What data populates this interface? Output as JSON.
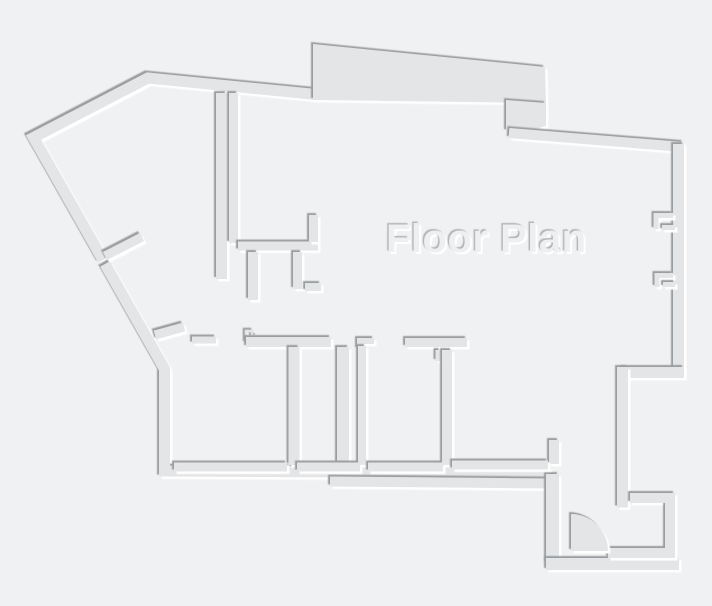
{
  "canvas": {
    "width": 712,
    "height": 606
  },
  "style": {
    "background": "#f0f1f2",
    "wall_fill": "#e4e5e6",
    "edge_dark": "#9b9ea0",
    "edge_light": "#ffffff"
  },
  "title": {
    "text": "Floor Plan",
    "color": "#edeff0",
    "shadow_dark": "#b2b5b7",
    "shadow_light": "#ffffff"
  },
  "pieces": [
    {
      "name": "outer-wall-upper-left",
      "type": "line",
      "w": 11,
      "pts": [
        [
          316,
          94.5
        ],
        [
          148,
          78
        ],
        [
          33.5,
          137.5
        ],
        [
          103,
          260
        ]
      ]
    },
    {
      "name": "outer-wall-lower-left",
      "type": "line",
      "w": 11,
      "pts": [
        [
          105,
          264
        ],
        [
          164.5,
          369
        ],
        [
          164.5,
          471
        ],
        [
          550,
          473
        ]
      ]
    },
    {
      "name": "bottom-outer-band",
      "type": "line",
      "w": 10,
      "pts": [
        [
          330,
          481.5
        ],
        [
          552,
          483.5
        ]
      ]
    },
    {
      "name": "entry-left-wall",
      "type": "line",
      "w": 13,
      "pts": [
        [
          552.5,
          474
        ],
        [
          552.5,
          563
        ]
      ]
    },
    {
      "name": "entry-bottom-outer-wall",
      "type": "line",
      "w": 12,
      "pts": [
        [
          546,
          564
        ],
        [
          679,
          564
        ]
      ]
    },
    {
      "name": "top-protrusion",
      "type": "poly",
      "pts": [
        [
          313,
          44
        ],
        [
          545,
          67
        ],
        [
          546,
          103
        ],
        [
          313,
          100
        ]
      ]
    },
    {
      "name": "protrusion-step",
      "type": "poly",
      "pts": [
        [
          506,
          100
        ],
        [
          546,
          103
        ],
        [
          546,
          126
        ],
        [
          518,
          134
        ],
        [
          506,
          131
        ]
      ]
    },
    {
      "name": "top-wall-right",
      "type": "line",
      "w": 10,
      "pts": [
        [
          509,
          133
        ],
        [
          683,
          147
        ]
      ]
    },
    {
      "name": "right-wall",
      "type": "line",
      "w": 11,
      "pts": [
        [
          678.5,
          144
        ],
        [
          678.5,
          373
        ]
      ]
    },
    {
      "name": "entry-jog-wall",
      "type": "line",
      "w": 11,
      "pts": [
        [
          684,
          372.5
        ],
        [
          622.5,
          372.5
        ]
      ]
    },
    {
      "name": "entry-upper-wall",
      "type": "line",
      "w": 11,
      "pts": [
        [
          622.5,
          367
        ],
        [
          622.5,
          507.5
        ]
      ]
    },
    {
      "name": "entry-inner-wall",
      "type": "line",
      "w": 10,
      "pts": [
        [
          630,
          498
        ],
        [
          670,
          498
        ],
        [
          670,
          553
        ],
        [
          608,
          553
        ]
      ]
    },
    {
      "name": "interior-wall-v1",
      "type": "line",
      "w": 11,
      "pts": [
        [
          221.5,
          93
        ],
        [
          221.5,
          279
        ]
      ]
    },
    {
      "name": "interior-wall-v2",
      "type": "line",
      "w": 9,
      "pts": [
        [
          233.5,
          93
        ],
        [
          233.5,
          243
        ]
      ]
    },
    {
      "name": "interior-wall-h1",
      "type": "line",
      "w": 9,
      "pts": [
        [
          238,
          246
        ],
        [
          318,
          246
        ]
      ]
    },
    {
      "name": "h1-riser",
      "type": "line",
      "w": 9,
      "pts": [
        [
          313.5,
          215
        ],
        [
          313.5,
          242
        ]
      ]
    },
    {
      "name": "closet-stub-a",
      "type": "line",
      "w": 10,
      "pts": [
        [
          253,
          252
        ],
        [
          253,
          300
        ]
      ]
    },
    {
      "name": "closet-stub-b",
      "type": "line",
      "w": 9,
      "pts": [
        [
          297.5,
          252
        ],
        [
          297.5,
          289
        ]
      ]
    },
    {
      "name": "closet-stub-c",
      "type": "line",
      "w": 8,
      "pts": [
        [
          305,
          287
        ],
        [
          321,
          287
        ]
      ]
    },
    {
      "name": "diag-door-jamb-a",
      "type": "line",
      "w": 9,
      "pts": [
        [
          105,
          256
        ],
        [
          142,
          237
        ]
      ]
    },
    {
      "name": "diag-door-jamb-b",
      "type": "line",
      "w": 9,
      "pts": [
        [
          155,
          335
        ],
        [
          184,
          327
        ]
      ]
    },
    {
      "name": "door-jamb-c",
      "type": "line",
      "w": 7,
      "pts": [
        [
          192,
          340
        ],
        [
          216,
          340
        ]
      ]
    },
    {
      "name": "step-glyph",
      "type": "line",
      "w": 2.5,
      "pts": [
        [
          246,
          343
        ],
        [
          246,
          331
        ],
        [
          252,
          331
        ],
        [
          252,
          336
        ],
        [
          257,
          336
        ]
      ]
    },
    {
      "name": "rooms-top-wall",
      "type": "line",
      "w": 10,
      "pts": [
        [
          246,
          342
        ],
        [
          331,
          342
        ]
      ]
    },
    {
      "name": "l-jamb",
      "type": "line",
      "w": 6,
      "pts": [
        [
          360,
          349
        ],
        [
          360,
          341
        ],
        [
          374,
          341
        ]
      ]
    },
    {
      "name": "room-divider-1",
      "type": "line",
      "w": 11,
      "pts": [
        [
          294,
          347
        ],
        [
          294,
          465
        ]
      ]
    },
    {
      "name": "room-divider-t",
      "type": "line",
      "w": 12,
      "pts": [
        [
          343,
          347
        ],
        [
          343,
          465
        ]
      ]
    },
    {
      "name": "room-divider-2",
      "type": "line",
      "w": 8,
      "pts": [
        [
          362,
          346
        ],
        [
          362,
          465
        ]
      ]
    },
    {
      "name": "divider-3-cap",
      "type": "line",
      "w": 9,
      "pts": [
        [
          405,
          342.5
        ],
        [
          467,
          342.5
        ]
      ]
    },
    {
      "name": "divider-3-stub",
      "type": "line",
      "w": 5,
      "pts": [
        [
          438,
          350
        ],
        [
          438,
          361
        ]
      ]
    },
    {
      "name": "room-divider-3",
      "type": "line",
      "w": 10,
      "pts": [
        [
          447,
          350
        ],
        [
          447,
          465
        ]
      ]
    },
    {
      "name": "hall-stub",
      "type": "line",
      "w": 10,
      "pts": [
        [
          554,
          440
        ],
        [
          554,
          464
        ]
      ]
    },
    {
      "name": "room1-bottom-wall",
      "type": "line",
      "w": 9,
      "pts": [
        [
          174,
          467
        ],
        [
          287,
          467
        ]
      ]
    },
    {
      "name": "room2-bottom-wall",
      "type": "line",
      "w": 9,
      "pts": [
        [
          297,
          467
        ],
        [
          360,
          467
        ]
      ]
    },
    {
      "name": "room3-bottom-wall",
      "type": "line",
      "w": 9,
      "pts": [
        [
          368,
          467
        ],
        [
          443,
          467
        ]
      ]
    },
    {
      "name": "room4-bottom-wall",
      "type": "line",
      "w": 9,
      "pts": [
        [
          452,
          465
        ],
        [
          548,
          465
        ]
      ]
    },
    {
      "name": "window-notch1-bracket",
      "type": "line",
      "w": 5,
      "pts": [
        [
          673,
          215.5
        ],
        [
          656,
          215.5
        ],
        [
          656,
          229
        ]
      ]
    },
    {
      "name": "window-notch1-stub",
      "type": "line",
      "w": 5,
      "pts": [
        [
          662,
          227.5
        ],
        [
          675,
          227.5
        ]
      ]
    },
    {
      "name": "window-notch2-bracket",
      "type": "line",
      "w": 5,
      "pts": [
        [
          673,
          275.5
        ],
        [
          657,
          275.5
        ],
        [
          657,
          287
        ]
      ]
    },
    {
      "name": "window-notch2-stub",
      "type": "line",
      "w": 5,
      "pts": [
        [
          663,
          284.5
        ],
        [
          675,
          284.5
        ]
      ]
    },
    {
      "name": "door-swing",
      "type": "pie",
      "cx": 570,
      "cy": 551,
      "r": 37
    }
  ]
}
